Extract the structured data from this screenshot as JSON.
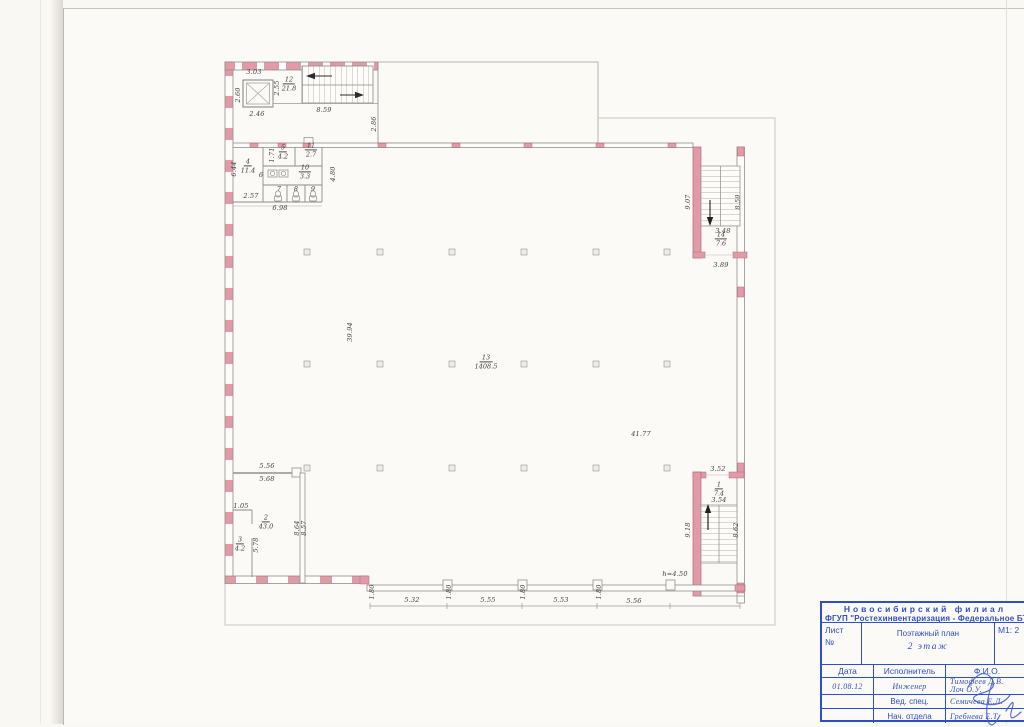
{
  "document": {
    "type": "floor-plan-sheet",
    "accent_blue": "#2e4ec6",
    "wall_pink": "#e19aa6"
  },
  "plan": {
    "rooms": [
      {
        "num": "12",
        "area": "21.8",
        "x": 289,
        "y": 84
      },
      {
        "num": "4",
        "area": "11.4",
        "x": 248,
        "y": 166
      },
      {
        "num": "5",
        "area": "4.2",
        "x": 283,
        "y": 152
      },
      {
        "num": "11",
        "area": "2.7",
        "x": 311,
        "y": 150
      },
      {
        "num": "10",
        "area": "3.3",
        "x": 305,
        "y": 172
      },
      {
        "num": "13",
        "area": "1408.5",
        "x": 486,
        "y": 362
      },
      {
        "num": "14",
        "area": "7.6",
        "x": 721,
        "y": 239
      },
      {
        "num": "1",
        "area": "7.4",
        "x": 719,
        "y": 489
      },
      {
        "num": "2",
        "area": "43.0",
        "x": 266,
        "y": 522
      },
      {
        "num": "3",
        "area": "4.2",
        "x": 240,
        "y": 544
      }
    ],
    "room_numbers": [
      {
        "t": "6",
        "x": 261,
        "y": 175
      },
      {
        "t": "7",
        "x": 279,
        "y": 189
      },
      {
        "t": "8",
        "x": 296,
        "y": 189
      },
      {
        "t": "9",
        "x": 313,
        "y": 189
      }
    ],
    "dimensions": [
      {
        "t": "3.03",
        "x": 254,
        "y": 72
      },
      {
        "t": "2.60",
        "x": 238,
        "y": 95,
        "v": 1
      },
      {
        "t": "2.55",
        "x": 277,
        "y": 88,
        "v": 1
      },
      {
        "t": "2.46",
        "x": 257,
        "y": 114
      },
      {
        "t": "8.59",
        "x": 324,
        "y": 110
      },
      {
        "t": "2.86",
        "x": 374,
        "y": 124,
        "v": 1
      },
      {
        "t": "1.71",
        "x": 272,
        "y": 155,
        "v": 1
      },
      {
        "t": "6.44",
        "x": 234,
        "y": 169,
        "v": 1
      },
      {
        "t": "2.57",
        "x": 251,
        "y": 196
      },
      {
        "t": "6.98",
        "x": 280,
        "y": 208
      },
      {
        "t": "4.80",
        "x": 333,
        "y": 174,
        "v": 1
      },
      {
        "t": "9.07",
        "x": 688,
        "y": 202,
        "v": 1
      },
      {
        "t": "8.59",
        "x": 738,
        "y": 202,
        "v": 1
      },
      {
        "t": "3.48",
        "x": 723,
        "y": 231
      },
      {
        "t": "3.89",
        "x": 721,
        "y": 265
      },
      {
        "t": "39.94",
        "x": 350,
        "y": 332,
        "v": 1
      },
      {
        "t": "41.77",
        "x": 641,
        "y": 434
      },
      {
        "t": "5.56",
        "x": 267,
        "y": 466
      },
      {
        "t": "5.68",
        "x": 267,
        "y": 479
      },
      {
        "t": "1.05",
        "x": 241,
        "y": 506
      },
      {
        "t": "8.64",
        "x": 297,
        "y": 528,
        "v": 1
      },
      {
        "t": "8.57",
        "x": 304,
        "y": 528,
        "v": 1
      },
      {
        "t": "5.78",
        "x": 256,
        "y": 545,
        "v": 1
      },
      {
        "t": "3.52",
        "x": 718,
        "y": 469
      },
      {
        "t": "3.54",
        "x": 719,
        "y": 500
      },
      {
        "t": "9.18",
        "x": 688,
        "y": 530,
        "v": 1
      },
      {
        "t": "8.62",
        "x": 736,
        "y": 530,
        "v": 1
      },
      {
        "t": "h=4.50",
        "x": 675,
        "y": 574
      },
      {
        "t": "1.80",
        "x": 372,
        "y": 592,
        "v": 1
      },
      {
        "t": "1.80",
        "x": 449,
        "y": 592,
        "v": 1
      },
      {
        "t": "1.80",
        "x": 523,
        "y": 592,
        "v": 1
      },
      {
        "t": "1.80",
        "x": 599,
        "y": 592,
        "v": 1
      },
      {
        "t": "5.32",
        "x": 412,
        "y": 600
      },
      {
        "t": "5.55",
        "x": 488,
        "y": 600
      },
      {
        "t": "5.53",
        "x": 561,
        "y": 600
      },
      {
        "t": "5.56",
        "x": 634,
        "y": 601
      }
    ],
    "columns": {
      "xs": [
        307,
        380,
        452,
        524,
        596,
        667
      ],
      "ys": [
        252,
        364,
        468
      ]
    }
  },
  "title_block": {
    "org_line1": "Новосибирский филиал",
    "org_line2": "ФГУП \"Ростехинвентаризация - Федеральное БТИ\"",
    "sheet_label": "Лист",
    "sheet_no": "№",
    "scale": "М1: 2",
    "plan_type": "Поэтажный план",
    "floor": "2 этаж",
    "col_date": "Дата",
    "col_role": "Исполнитель",
    "col_fio": "Ф.И.О.",
    "rows": [
      {
        "date": "01.08.12",
        "role": "Инженер",
        "name": "Тимофеев Д.В.",
        "name2": "Лоч О.У."
      },
      {
        "date": "",
        "role": "Вед. спец.",
        "name": "Семичева Е.Л.",
        "name2": ""
      },
      {
        "date": "",
        "role": "Нач. отдела",
        "name": "Гребнева Е.Т.",
        "name2": ""
      }
    ]
  }
}
